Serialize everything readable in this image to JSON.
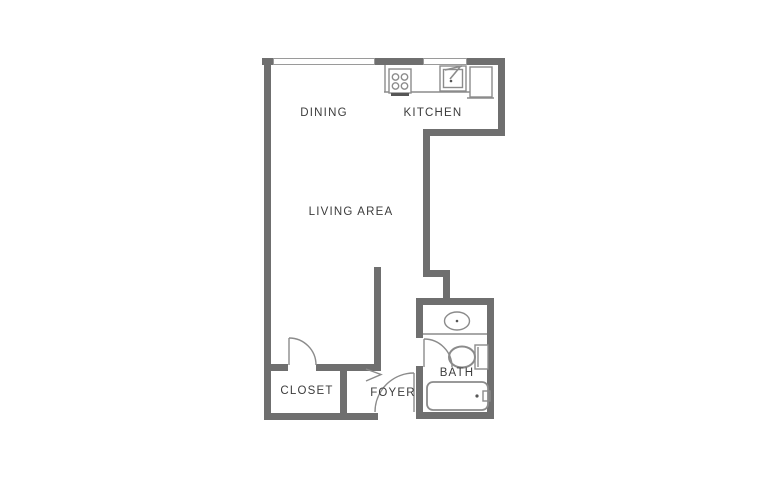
{
  "meta": {
    "type": "apartment-floor-plan",
    "background_color": "#ffffff"
  },
  "colors": {
    "wall": "#6f6f6f",
    "fixture_outline": "#8b8b8b",
    "label_text": "#3c3c3c",
    "appliance_dark": "#565656",
    "window_fill": "#ffffff"
  },
  "rooms": {
    "dining": "DINING",
    "kitchen": "KITCHEN",
    "living": "LIVING AREA",
    "closet": "CLOSET",
    "foyer": "FOYER",
    "bath": "BATH"
  },
  "fixtures": {
    "stove": "stove-4-burner-icon",
    "kitchen_sink": "kitchen-sink-icon",
    "refrigerator": "refrigerator-icon",
    "bathroom_sink": "vanity-sink-icon",
    "toilet": "toilet-icon",
    "bathtub": "bathtub-icon",
    "windows": "window-symbol",
    "doors": "door-swing-symbol",
    "opening_marker": "chevron-opening-symbol"
  }
}
